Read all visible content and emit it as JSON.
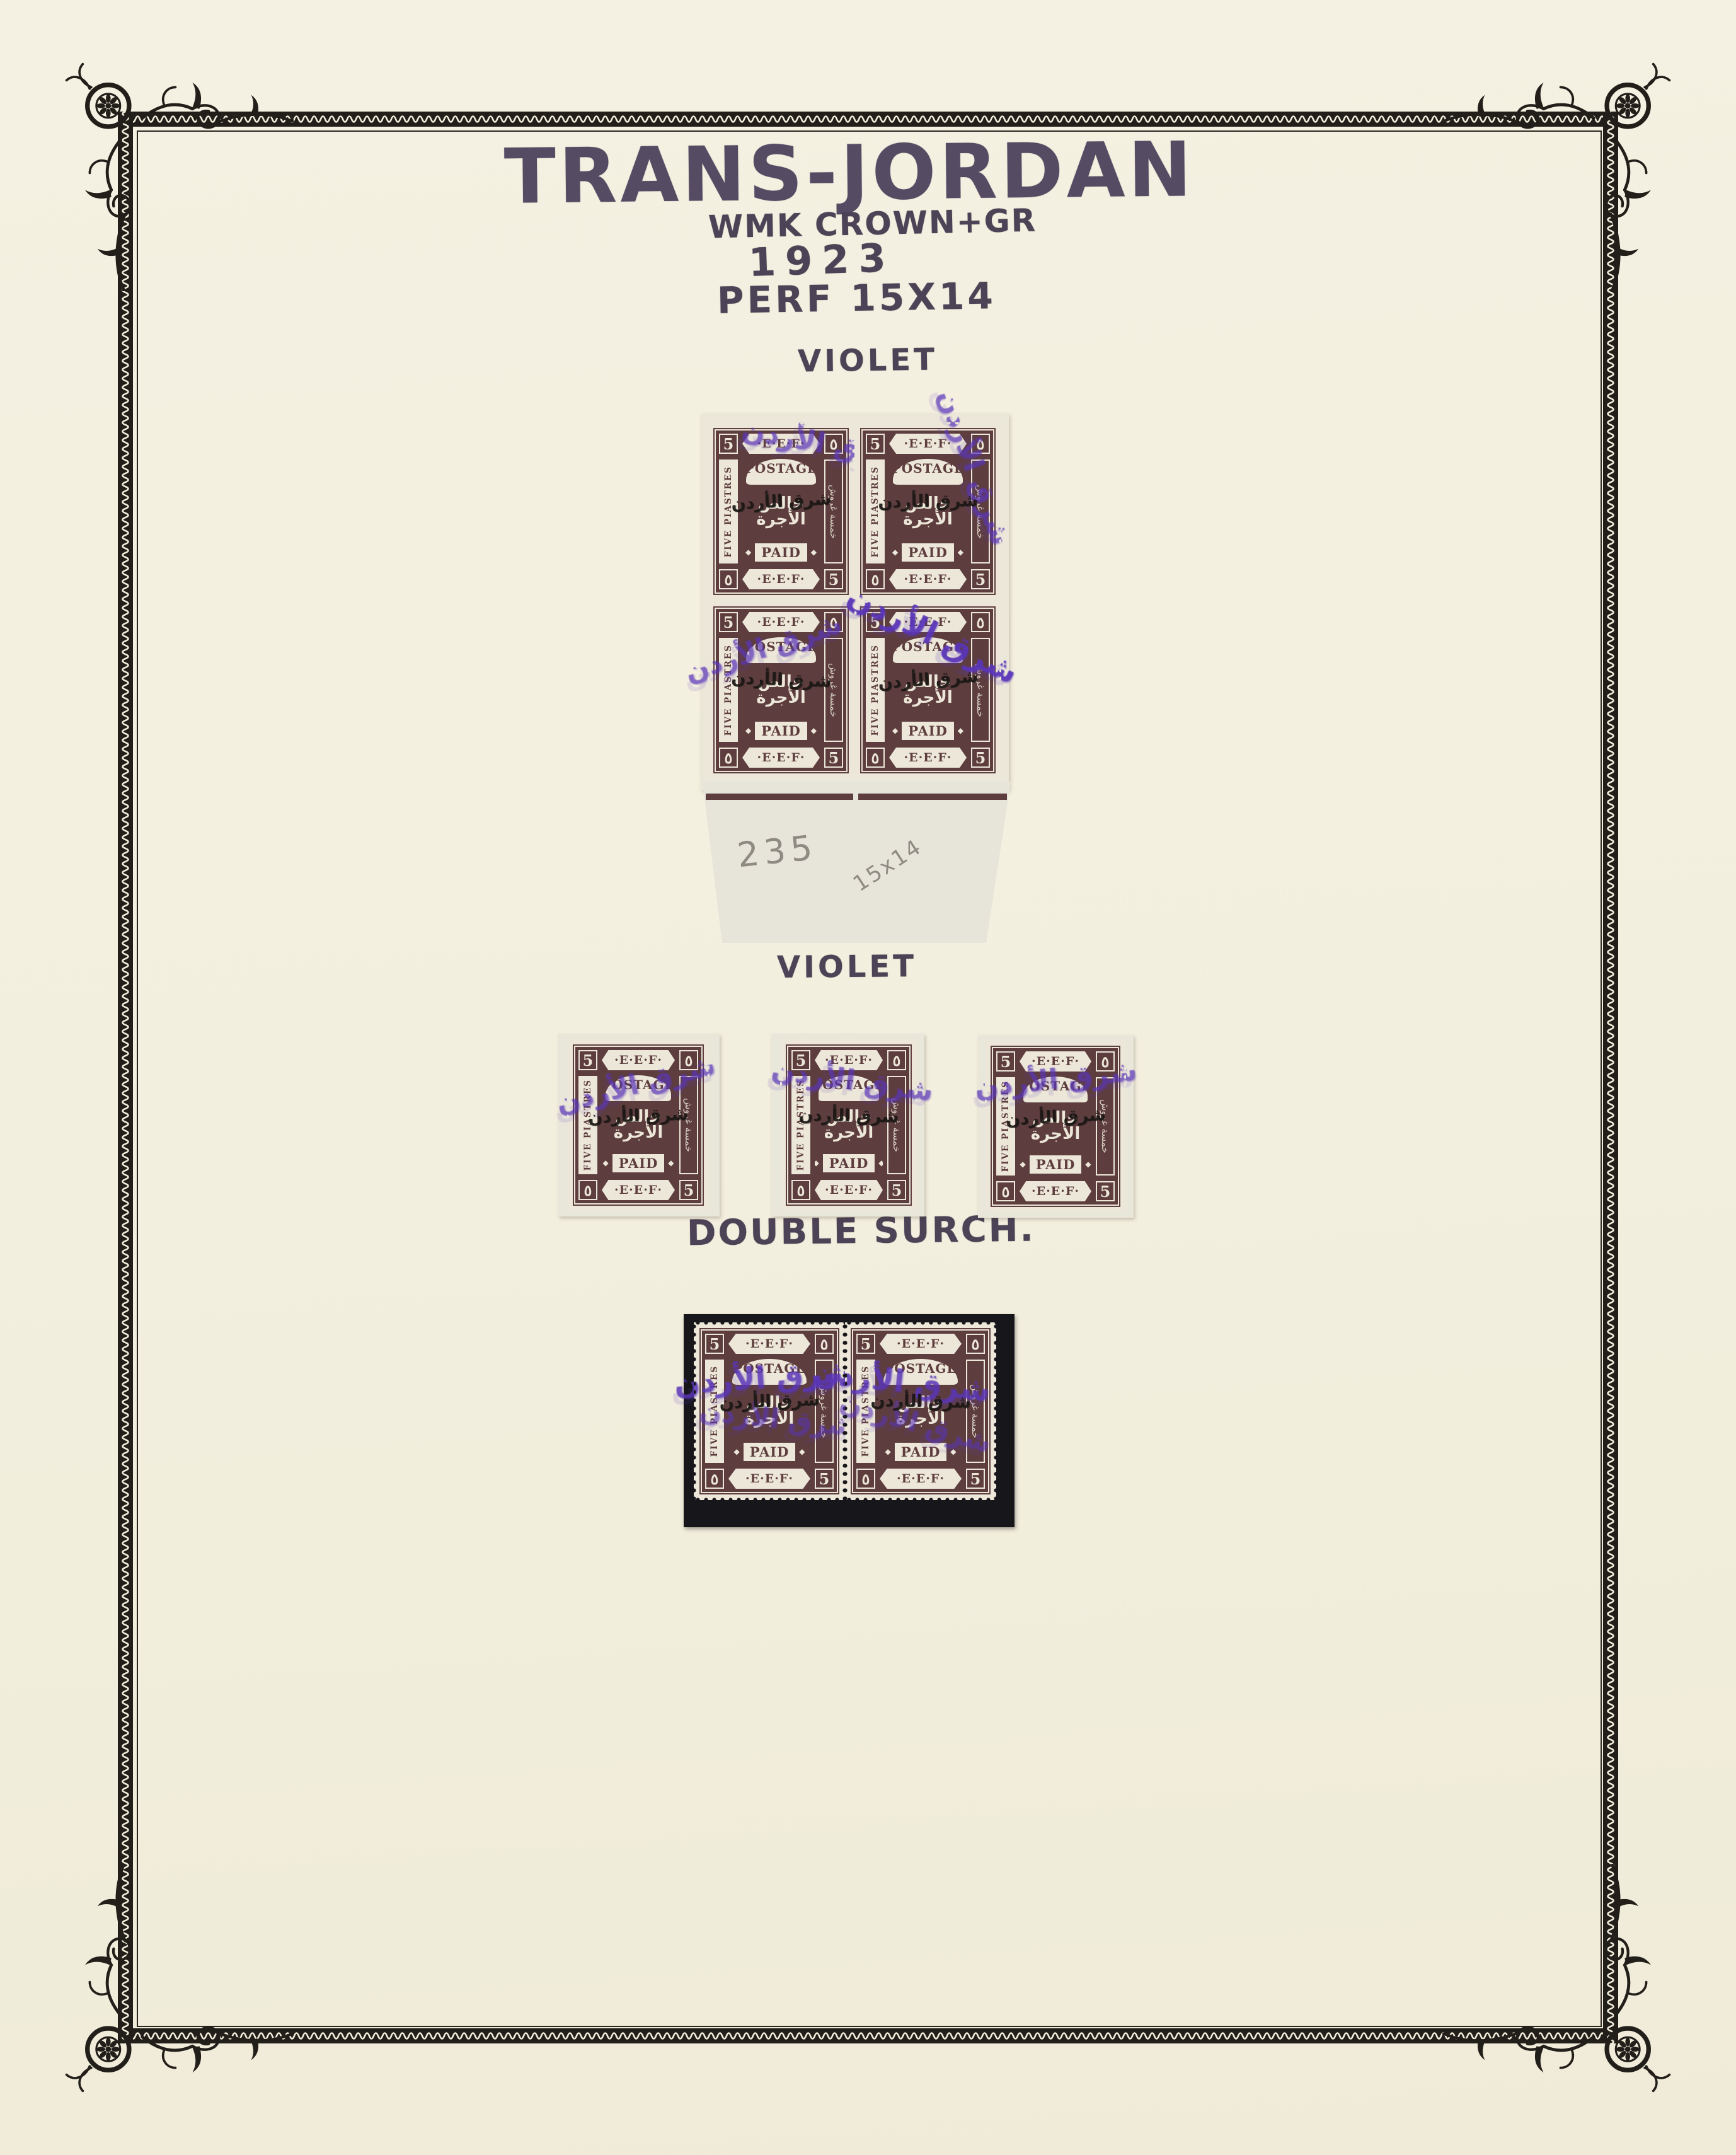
{
  "page": {
    "title": "TRANS-JORDAN",
    "watermark_note": "WMK CROWN+GR",
    "year": "1923",
    "perforation": "PERF 15X14",
    "label_violet_top": "VIOLET",
    "label_violet_middle": "VIOLET",
    "label_double_surcharge": "DOUBLE SURCH."
  },
  "sections": {
    "block_of_four": {
      "heading": "VIOLET",
      "stamp_count": 4,
      "selvage_pencil_number": "235",
      "selvage_pencil_perf": "15x14"
    },
    "singles_row": {
      "heading": "VIOLET",
      "stamp_count": 3
    },
    "double_surcharge_pair": {
      "heading": "DOUBLE SURCH.",
      "stamp_count": 2
    }
  },
  "stamp": {
    "value_numeral": "5",
    "value_arabic_numeral": "٥",
    "eef_top": "·E·E·F·",
    "eef_bottom": "·E·E·F·",
    "postage": "POSTAGE",
    "paid": "PAID",
    "diamond": "◆",
    "side_text": "FIVE PIASTRES",
    "side_arabic": "خمسة غروش",
    "center_arabic": "خالص الأجرة",
    "overprint_black_arabic": "شرق الأردن",
    "overprint_violet_arabic": "شرق الأردن"
  },
  "colors": {
    "page_paper": "#f3efde",
    "border_ink": "#221f1a",
    "handwriting": "#4c4456",
    "pencil": "#8f8b83",
    "stamp_ink": "#5e3d3f",
    "stamp_paper": "#ece7d8",
    "black_overprint": "#1a1713",
    "violet_handstamp": "#5a35b8",
    "mount": "#17161b"
  }
}
